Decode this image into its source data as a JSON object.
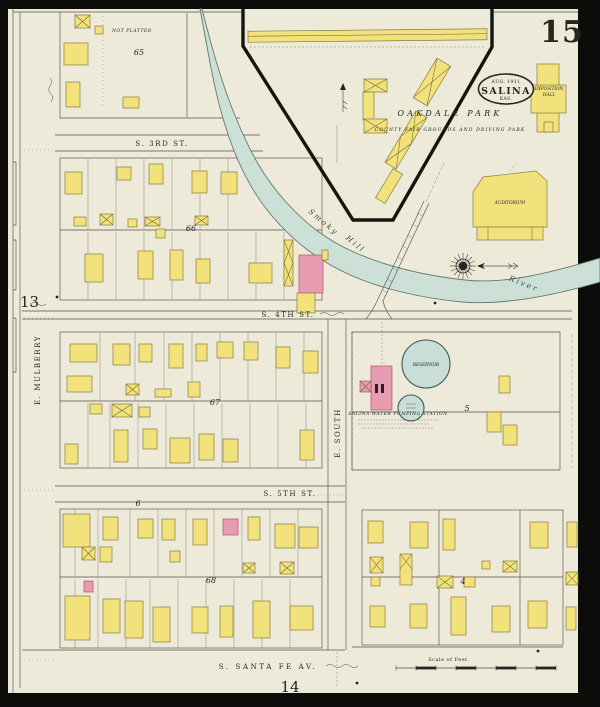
{
  "sheet": {
    "number": "15",
    "ref_bottom": "14",
    "ref_left": "13"
  },
  "stamp": {
    "date": "AUG. 1911",
    "city": "SALINA",
    "state": "KAS."
  },
  "park": {
    "name": "OAKDALE PARK",
    "subtitle": "COUNTY FAIR GROUNDS AND DRIVING PARK"
  },
  "river": {
    "word1": "Smoky",
    "word2": "Hill",
    "word3": "River"
  },
  "streets": {
    "s3rd": "S. 3RD ST.",
    "s4th": "S. 4TH ST.",
    "s5th": "S. 5TH ST.",
    "santa_fe": "S. SANTA FE AV.",
    "mulberry": "E. MULBERRY",
    "south": "E. SOUTH"
  },
  "labels": {
    "not_platted": "NOT PLATTED",
    "auditorium": "AUDITORIUM",
    "exposition_line1": "EXPOSITION",
    "exposition_line2": "HALL",
    "pumping_station": "SALINA WATER PUMPING STATION",
    "reservoir": "RESERVOIR",
    "scale": "Scale of Feet."
  },
  "blocks": {
    "b65": "65",
    "b66": "66",
    "b67": "67",
    "b68": "68",
    "b6": "6",
    "b5": "5",
    "b4": "4"
  },
  "colors": {
    "paper": "#edead9",
    "building_frame": "#f1e27b",
    "building_brick": "#e79cb1",
    "river": "#cde0d8",
    "ink": "#262521",
    "border": "#0c0c0a"
  }
}
